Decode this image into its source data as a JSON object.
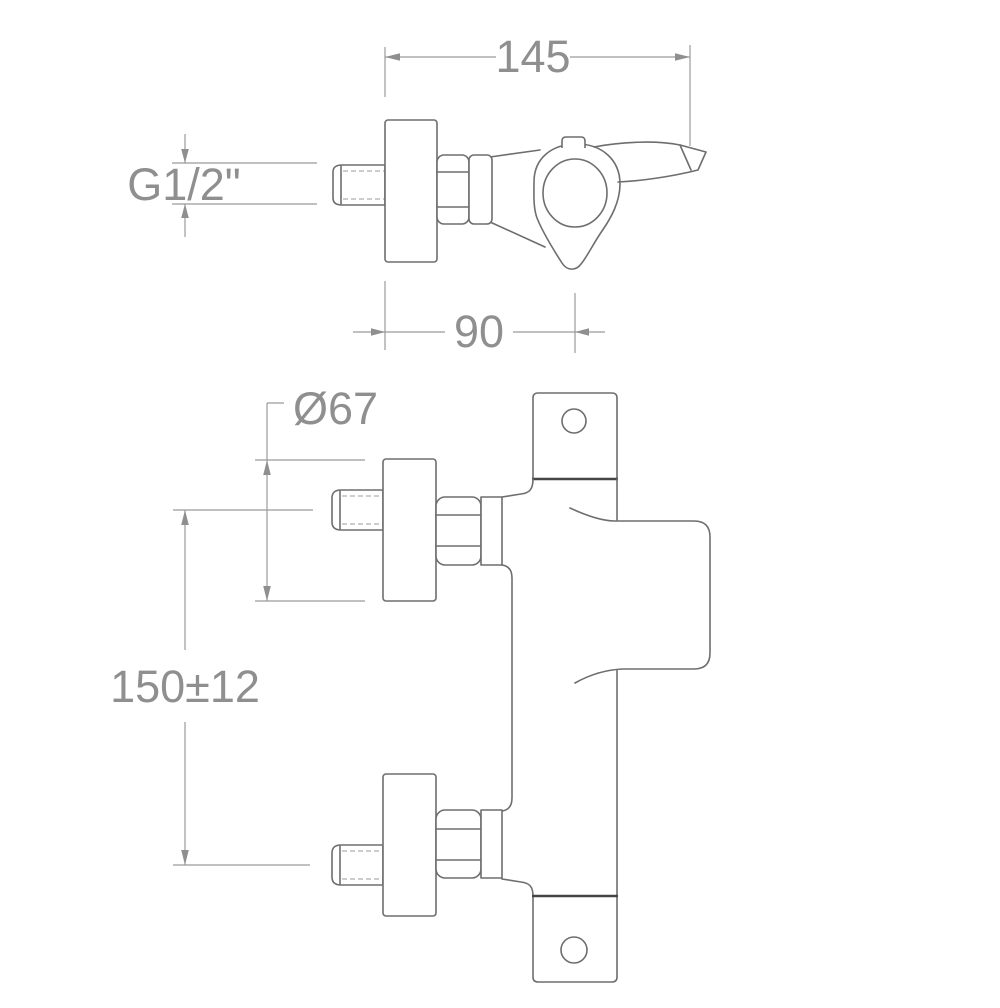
{
  "drawing": {
    "type": "technical-dimension-drawing",
    "subject": "wall-mounted single-lever shower mixer",
    "dimensions": {
      "overall_width": "145",
      "thread_size": "G1/2\"",
      "body_depth": "90",
      "flange_diameter": "Ø67",
      "inlet_spacing": "150±12"
    },
    "colors": {
      "background": "#ffffff",
      "outline": "#6e6e6e",
      "dark_edge": "#454545",
      "dimension_line": "#9b9b9b",
      "dimension_text": "#8f8f8f"
    }
  }
}
